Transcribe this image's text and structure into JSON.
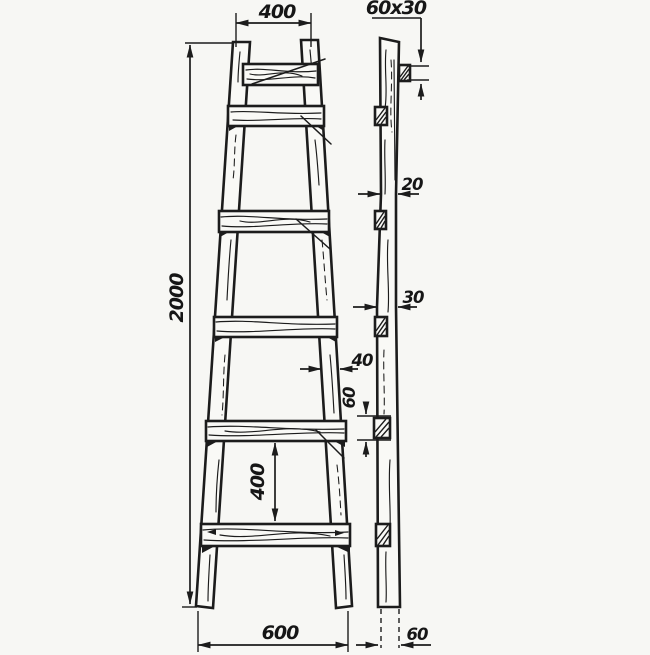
{
  "meta": {
    "drawing_type": "technical drawing",
    "subject": "Wooden step ladder - front view and side view with dimensions in mm"
  },
  "colors": {
    "ink": "#1c1c1c",
    "paper": "#f9f9f6"
  },
  "front_view": {
    "top_width": "400",
    "overall_height": "2000",
    "bottom_width": "600",
    "rung_spacing": "400",
    "stile_width": "40",
    "rung_count": 6
  },
  "side_view": {
    "stile_section": "60x30",
    "stile_thickness_top": "20",
    "stile_thickness_middle": "30",
    "tenon_height": "60",
    "foot_width": "60",
    "tenon_count": 6
  }
}
